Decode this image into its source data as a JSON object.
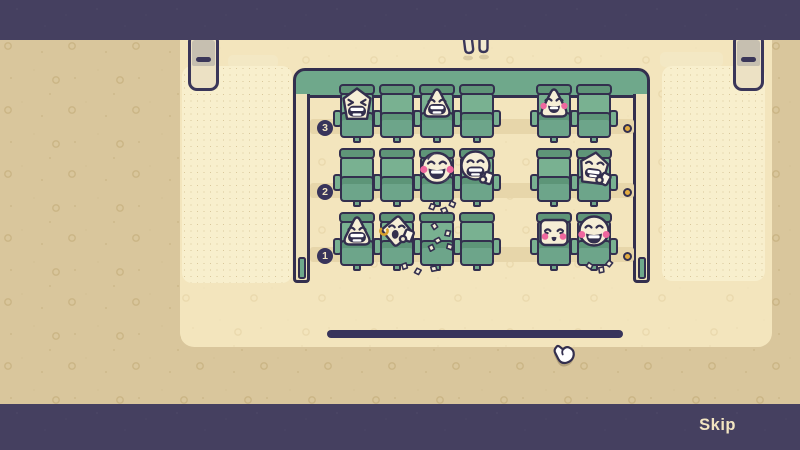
{
  "chrome": {
    "skip_label": "Skip"
  },
  "icons": {
    "cursor": "hand-pointer-icon",
    "door": "door-icon",
    "row_light": "aisle-light-dot",
    "peeking": "dangling-legs"
  },
  "palette": {
    "letterbox_bar": "#454060",
    "background": "#d9c69c",
    "room_floor": "#f3e5bd",
    "carpet": "#f8efcd",
    "seat_green": "#79b191",
    "seat_green_dark": "#5d9478",
    "wall_green": "#6fa88b",
    "outline": "#332f4e",
    "blush_pink": "#ee679e",
    "light_gold": "#e3ac41",
    "text_cream": "#f2e5c1"
  },
  "theater": {
    "rows": [
      {
        "label": "3",
        "left_seats": [
          {
            "occupant": "pentagon-grin"
          },
          {
            "occupant": null
          },
          {
            "occupant": "triangle-grin"
          },
          {
            "occupant": null
          }
        ],
        "right_seats": [
          {
            "occupant": "triangle-blush"
          },
          {
            "occupant": null
          }
        ]
      },
      {
        "label": "2",
        "left_seats": [
          {
            "occupant": null
          },
          {
            "occupant": null
          },
          {
            "occupant": "ball-blush-laugh"
          },
          {
            "occupant": "round-cup-laugh"
          }
        ],
        "right_seats": [
          {
            "occupant": null
          },
          {
            "occupant": "pentagon-cup"
          }
        ]
      },
      {
        "label": "1",
        "left_seats": [
          {
            "occupant": "triangle-grin"
          },
          {
            "occupant": "diamond-cup"
          },
          {
            "occupant": null
          },
          {
            "occupant": null
          }
        ],
        "right_seats": [
          {
            "occupant": "square-blush"
          },
          {
            "occupant": "round-blush-laugh"
          }
        ]
      }
    ],
    "debris": [
      {
        "type": "ring",
        "x": 85,
        "y": 156
      },
      {
        "type": "crumb",
        "x": 137,
        "y": 150
      },
      {
        "type": "crumb",
        "x": 150,
        "y": 157
      },
      {
        "type": "crumb",
        "x": 140,
        "y": 164
      },
      {
        "type": "crumb",
        "x": 152,
        "y": 170
      },
      {
        "type": "crumb",
        "x": 134,
        "y": 171
      },
      {
        "type": "crumb",
        "x": 135,
        "y": 130
      },
      {
        "type": "crumb",
        "x": 147,
        "y": 134
      },
      {
        "type": "crumb",
        "x": 155,
        "y": 128
      },
      {
        "type": "crumb",
        "x": 107,
        "y": 190
      },
      {
        "type": "crumb",
        "x": 120,
        "y": 195
      },
      {
        "type": "crumb",
        "x": 136,
        "y": 192
      },
      {
        "type": "crumb",
        "x": 292,
        "y": 189
      },
      {
        "type": "crumb",
        "x": 304,
        "y": 193
      },
      {
        "type": "crumb",
        "x": 312,
        "y": 187
      }
    ]
  }
}
